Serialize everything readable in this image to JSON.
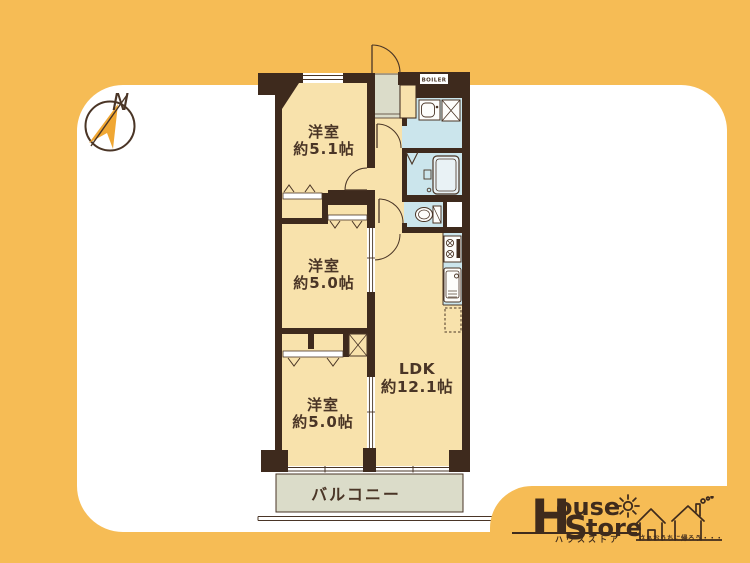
{
  "page": {
    "background": "#F6BC55",
    "card_color": "#FFFFFF"
  },
  "compass": {
    "north": "N"
  },
  "plan": {
    "rooms": {
      "bedroom1": {
        "name": "洋室",
        "size": "約5.1帖"
      },
      "bedroom2": {
        "name": "洋室",
        "size": "約5.0帖"
      },
      "bedroom3": {
        "name": "洋室",
        "size": "約5.0帖"
      },
      "ldk": {
        "name": "LDK",
        "size": "約12.1帖"
      },
      "balcony": {
        "name": "バルコニー"
      },
      "boiler": {
        "label": "BOILER"
      }
    },
    "colors": {
      "wall": "#3E2A1D",
      "room_fill": "#F8E2AC",
      "wet_area_fill": "#CBE5EC",
      "tile_fill": "#DBDCC9",
      "outline": "#4A3526"
    }
  },
  "logo": {
    "brand_h": "H",
    "brand_ouse": "ouse",
    "brand_s": "S",
    "brand_tore": "tore",
    "kana": "ハウスストア",
    "slogan": "さぁおうちに帰ろう・・・",
    "colors": {
      "brown": "#3F2B1C",
      "accent_orange": "#F0A733"
    }
  }
}
